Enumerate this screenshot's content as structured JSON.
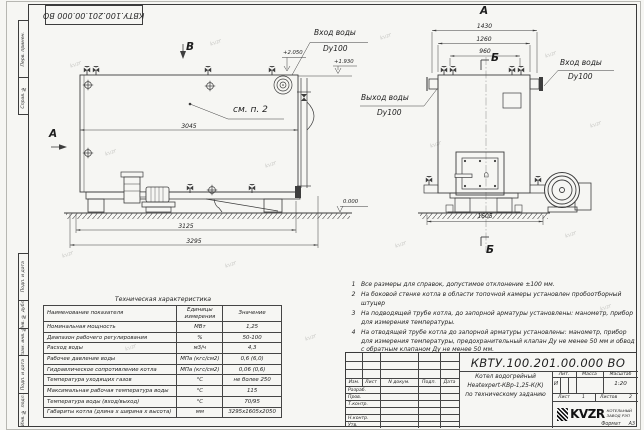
{
  "doc_number": "КВТУ.100.201.00.000 ВО",
  "watermark": "kvzr",
  "frame": {
    "top_cells": [
      "Перв. примен.",
      "Справ. №"
    ],
    "bottom_cells": [
      "Подп. и дата",
      "Инв. № дубл.",
      "Взам. инв. №",
      "Подп. и дата",
      "Инв. № подл."
    ],
    "format_label": "Формат",
    "format_value": "А3"
  },
  "drawing": {
    "side_view": {
      "view_label": "В",
      "dir_label": "А",
      "note_ref": "см. п. 2",
      "dim_top": "3045",
      "dim_mid": "3125",
      "dim_overall": "3295",
      "inlet_label": "Вход воды",
      "inlet_dn": "Dy100",
      "outlet_label": "Выход воды",
      "outlet_dn": "Dy100",
      "elev_inlet": "+2.050",
      "elev_top": "+1.930",
      "elev_zero": "0.000"
    },
    "front_view": {
      "view_label": "А",
      "section_label": "Б",
      "dim_w1": "1430",
      "dim_w2": "1260",
      "dim_w3": "960",
      "dim_base": "1605",
      "inlet_label": "Вход воды",
      "inlet_dn": "Dy100"
    }
  },
  "notes": [
    {
      "n": "1",
      "text": "Все размеры для справок, допустимое отклонение ±100 мм."
    },
    {
      "n": "2",
      "text": "На боковой стенке котла в области топочной камеры установлен пробоотборный штуцер"
    },
    {
      "n": "3",
      "text": "На подводящей трубе котла, до запорной арматуры установлены: манометр, прибор для измерения температуры."
    },
    {
      "n": "4",
      "text": "На отводящей трубе котла до запорной арматуры установлены: манометр, прибор для измерения температуры, предохранительный клапан Ду не менее 50 мм и обвод с обратным клапаном Ду не менее 50 мм."
    }
  ],
  "spec_table": {
    "title": "Техническая характеристика",
    "headers": [
      "Наименование показателя",
      "Единицы измерения",
      "Значение"
    ],
    "rows": [
      [
        "Номинальная мощность",
        "МВт",
        "1,25"
      ],
      [
        "Диапазон рабочего регулирования",
        "%",
        "50-100"
      ],
      [
        "Расход воды",
        "м3/ч",
        "4,3"
      ],
      [
        "Рабочее давление воды",
        "МПа (кгс/см2)",
        "0,6 (6,0)"
      ],
      [
        "Гидравлическое сопротивление котла",
        "МПа (кгс/см2)",
        "0,06 (0,6)"
      ],
      [
        "Температура уходящих газов",
        "°С",
        "не более 250"
      ],
      [
        "Максимальная рабочая температура воды",
        "°С",
        "115"
      ],
      [
        "Температура воды (вход/выход)",
        "°С",
        "70/95"
      ],
      [
        "Габариты котла (длина х ширина х высота)",
        "мм",
        "3295х1605х2050"
      ]
    ]
  },
  "title_block": {
    "product_name": [
      "Котел водогрейный",
      "Heatexpert-КВр-1,25-К(К)",
      "по техническому заданию"
    ],
    "rev_headers": [
      "Изм.",
      "Лист",
      "N докум.",
      "Подп.",
      "Дата"
    ],
    "role_rows": [
      "Разраб.",
      "Пров.",
      "Т.контр.",
      "",
      "Н.контр.",
      "Утв."
    ],
    "lit_header": "Лит.",
    "mass_header": "Масса",
    "scale_header": "Масштаб",
    "lit": "И",
    "scale": "1:20",
    "sheet_label": "Лист",
    "sheet": "1",
    "sheets_label": "Листов",
    "sheets": "2",
    "company_logo": "KVZR",
    "company_name": [
      "КОТЕЛЬНЫЙ",
      "ЗАВОД РЭП"
    ]
  }
}
